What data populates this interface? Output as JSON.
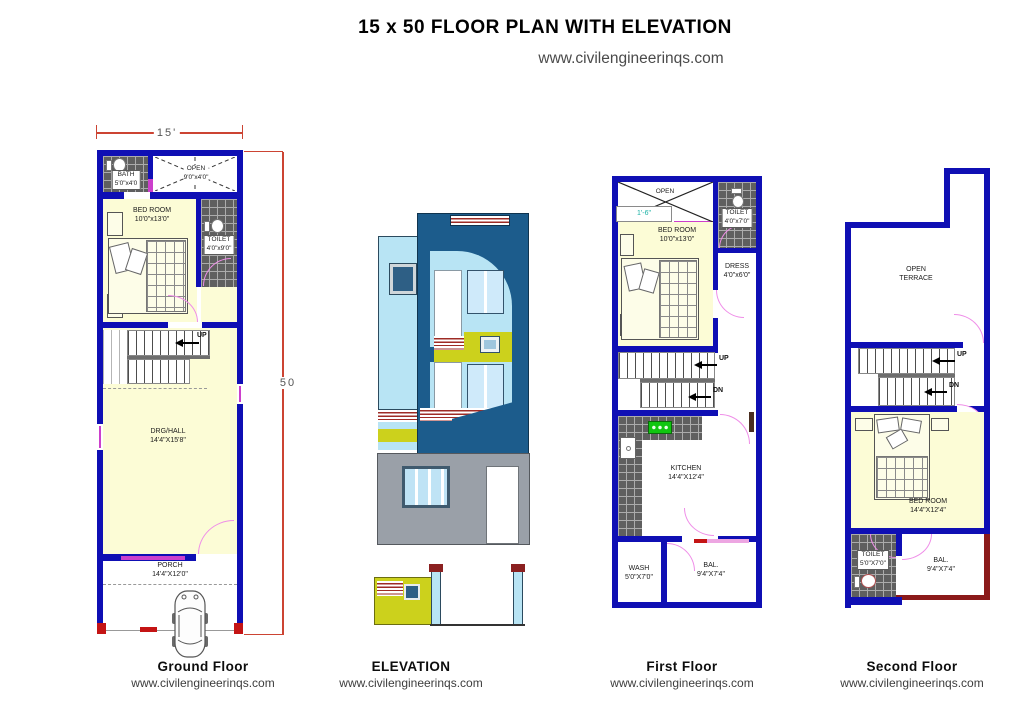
{
  "header": {
    "title": "15 x 50 FLOOR PLAN WITH ELEVATION",
    "website": "www.civilengineerinqs.com"
  },
  "ground_floor": {
    "caption": "Ground Floor",
    "website": "www.civilengineerinqs.com",
    "dim_width": "15'",
    "dim_height": "50",
    "bath": {
      "name": "BATH",
      "size": "5'0\"x4'0"
    },
    "open": {
      "name": "OPEN",
      "size": "9'0\"x4'0\""
    },
    "bedroom": {
      "name": "BED ROOM",
      "size": "10'0\"x13'0\""
    },
    "toilet": {
      "name": "TOILET",
      "size": "4'0\"x9'0\""
    },
    "hall": {
      "name": "DRG/HALL",
      "size": "14'4\"X15'8\""
    },
    "porch": {
      "name": "PORCH",
      "size": "14'4\"X12'0\""
    },
    "stairs_up": "UP"
  },
  "elevation": {
    "caption": "ELEVATION",
    "website": "www.civilengineerinqs.com"
  },
  "first_floor": {
    "caption": "First Floor",
    "website": "www.civilengineerinqs.com",
    "open": {
      "name": "OPEN"
    },
    "ledge": "1'-6\"",
    "toilet": {
      "name": "TOILET",
      "size": "4'0\"x7'0\""
    },
    "bedroom": {
      "name": "BED ROOM",
      "size": "10'0\"x13'0\""
    },
    "dress": {
      "name": "DRESS",
      "size": "4'0\"x6'0\""
    },
    "kitchen": {
      "name": "KITCHEN",
      "size": "14'4\"X12'4\""
    },
    "wash": {
      "name": "WASH",
      "size": "5'0\"X7'0\""
    },
    "balcony": {
      "name": "BAL.",
      "size": "9'4\"X7'4\""
    },
    "stairs_up": "UP",
    "stairs_down": "DN"
  },
  "second_floor": {
    "caption": "Second Floor",
    "website": "www.civilengineerinqs.com",
    "terrace": {
      "name": "OPEN",
      "name2": "TERRACE"
    },
    "bedroom": {
      "name": "BED ROOM",
      "size": "14'4\"X12'4\""
    },
    "toilet": {
      "name": "TOILET",
      "size": "5'0\"X7'0\""
    },
    "balcony": {
      "name": "BAL.",
      "size": "9'4\"X7'4\""
    },
    "stairs_up": "UP",
    "stairs_down": "DN"
  },
  "colors": {
    "wall": "#0f0fb4",
    "room_fill": "#fcfcd6",
    "door_arc": "#ef8ee8",
    "dimension_line": "#cc4433",
    "elevation_dark_blue": "#1c5c8c",
    "elevation_light_blue": "#b8e4f4",
    "elevation_yellow": "#ccd11c",
    "elevation_gray": "#9aa0a8"
  }
}
